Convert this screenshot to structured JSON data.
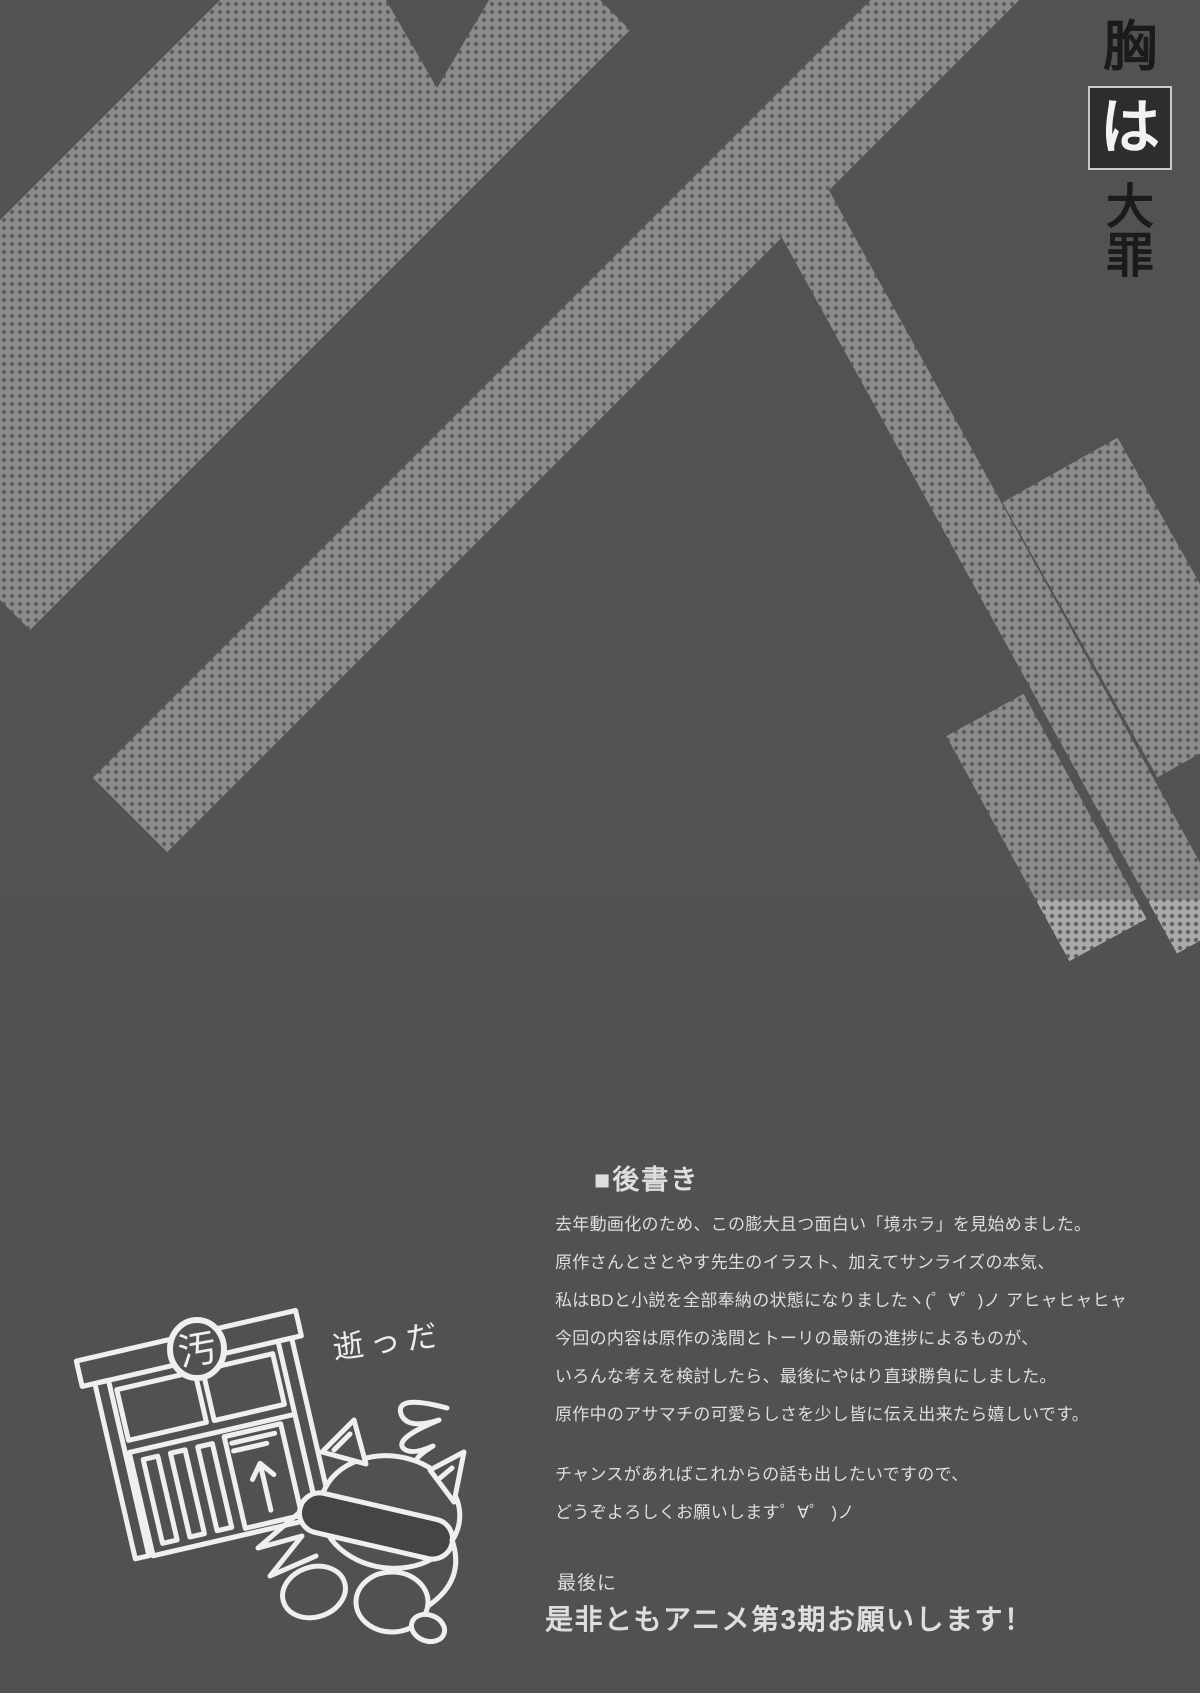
{
  "background": {
    "base_color": "#515151",
    "halftone_light": "#a9a9a9",
    "halftone_dot": "#606060",
    "description": "dark gray scanned page with halftone-dotted diagonal bars"
  },
  "title": {
    "char_top": "胸",
    "char_boxed": "は",
    "chars_bottom": [
      "大",
      "罪"
    ],
    "text_color": "#1b1b1b",
    "boxed_text_color": "#f2f2f2",
    "box_fill": "#2d2d2d",
    "box_border": "#c9c9c9"
  },
  "afterword": {
    "heading": "■後書き",
    "text_color": "#dedede",
    "p1": [
      "去年動画化のため、この膨大且つ面白い「境ホラ」を見始めました。",
      "原作さんとさとやす先生のイラスト、加えてサンライズの本気、",
      "私はBDと小説を全部奉納の状態になりましたヽ(゜∀゜)ノ アヒャヒャヒャ"
    ],
    "p2": [
      "今回の内容は原作の浅間とトーリの最新の進捗によるものが、",
      "いろんな考えを検討したら、最後にやはり直球勝負にしました。",
      "原作中のアサマチの可愛らしさを少し皆に伝え出来たら嬉しいです。"
    ],
    "p3": [
      "チャンスがあればこれからの話も出したいですので、",
      "どうぞよろしくお願いします゜∀゜ )ノ"
    ],
    "closing_small": "最後に",
    "closing_big": "是非ともアニメ第3期お願いします！"
  },
  "doodle": {
    "caption": "逝っだ",
    "crest_char": "汚",
    "line_color": "#efefef",
    "description": "hand-drawn offering box and slumped raccoon critter with dizzy swirl"
  }
}
